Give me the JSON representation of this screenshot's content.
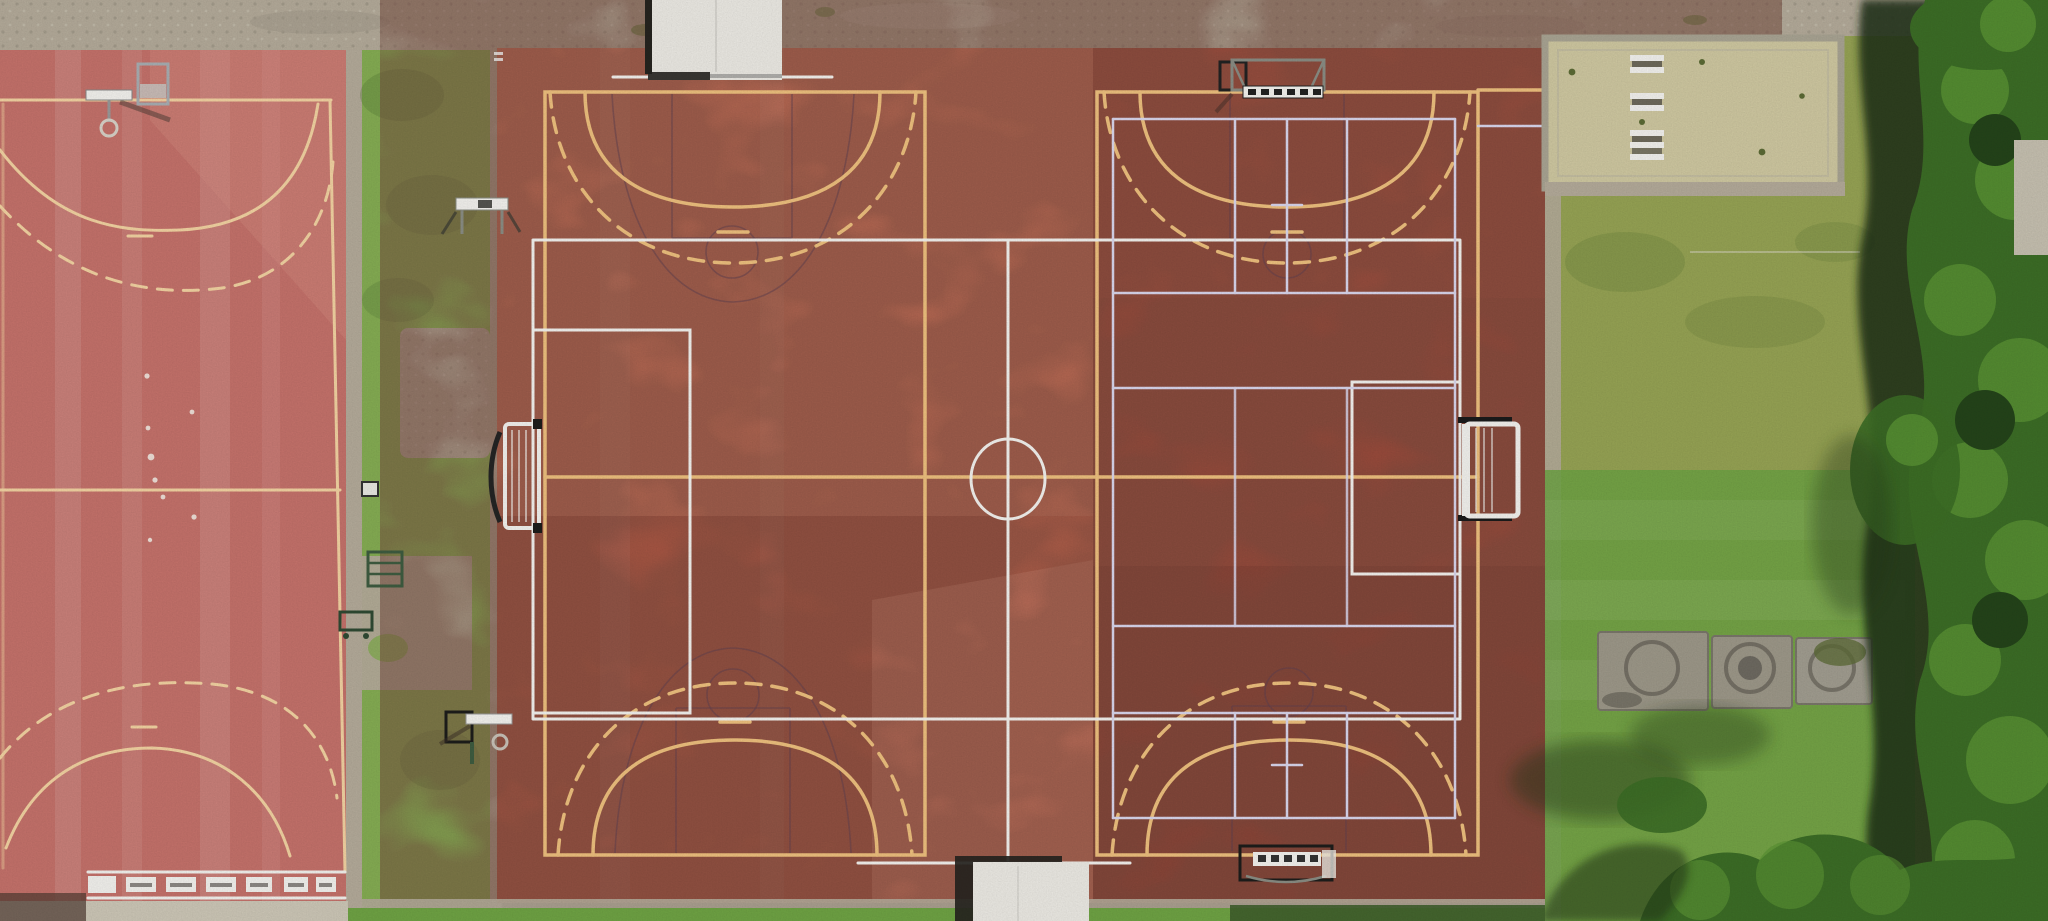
{
  "scene": {
    "title": "Aerial top-down drone photo of outdoor school sports courts",
    "description": "Nadir drone view: three adjoining red sports courts with overlapping handball, football, basketball and volleyball markings, grass strips with training equipment, a dry sandy patch, concrete pads and a dense tree line casting hard shadows on the right; gravel paths border the courts.",
    "areas": [
      {
        "name": "left-court",
        "surface": "faded pink-red acrylic",
        "markings": [
          "cream goal-area arcs top and bottom",
          "dashed free-throw arcs",
          "halfway line",
          "row of white finish blocks at the south end"
        ]
      },
      {
        "name": "left-grass-strip",
        "surface": "grass with gravel patches",
        "contains": [
          "training goal",
          "mini goal",
          "climbing frame",
          "small sign"
        ]
      },
      {
        "name": "center-court",
        "surface": "orange-red acrylic, mottled",
        "markings": [
          "yellow handball court with solid and dashed goal arcs",
          "white football pitch with centre circle",
          "faint dark basketball key and circles"
        ]
      },
      {
        "name": "right-court",
        "surface": "dark brick-red acrylic",
        "markings": [
          "yellow handball court with goal arcs",
          "lavender volleyball/badminton grid",
          "white goal areas"
        ]
      },
      {
        "name": "north-extension",
        "surface": "red acrylic L-extension with white bench markings"
      },
      {
        "name": "east-grass",
        "surface": "olive and bright green lawn",
        "contains": [
          "dry sandy patch",
          "three concrete pads with circular covers",
          "tree shadows"
        ]
      },
      {
        "name": "tree-line",
        "surface": "dense deciduous canopy along the east edge"
      }
    ],
    "equipment": [
      "basketball-hoop-northwest",
      "training-goal-west",
      "mini-goal-west",
      "basketball-hoop-southwest",
      "climbing-frame-west",
      "sign-west",
      "handball-goal-north",
      "handball-goal-south",
      "football-goal-east",
      "shed-north",
      "shed-south",
      "concrete-pads-east",
      "bench-markings-northeast"
    ],
    "lighting": "bright sunlight, shadows cast toward the west"
  },
  "colors": {
    "gravel": "#b4ab9a",
    "gravel_light": "#c8c2b2",
    "concrete": "#cdc7b7",
    "court_left": "#c5726b",
    "court_left_light": "#d88f85",
    "court_mid": "#c6654d",
    "court_mid_light": "#e09277",
    "court_mid_dark": "#8e4437",
    "court_mid_pale": "#e8927a",
    "court_right": "#a04b3b",
    "court_right_light": "#b85a44",
    "court_right_dark": "#7e3a2e",
    "court_ext": "#b25740",
    "line_cream": "#f3d3a2",
    "line_yellow": "#eec07e",
    "line_white": "#f3f2ee",
    "line_lavender": "#d9d6ec",
    "line_dark": "#5f4050",
    "grass": "#85ad53",
    "grass_olive": "#96a354",
    "grass_bright": "#6fa344",
    "grass_dark": "#597f37",
    "tree": "#3c6d26",
    "tree_light": "#5a9334",
    "tree_dark": "#24441a",
    "tree_shadow": "#1c2d12",
    "shadow_green": "#233517",
    "dry_patch": "#cfc8a1",
    "pad": "#9d9889",
    "white_struct": "#eceae4",
    "struct_dark": "#26241f",
    "goal_metal": "#8a8d84",
    "goal_green": "#3e5c40",
    "goal_black": "#1d1d1b"
  }
}
